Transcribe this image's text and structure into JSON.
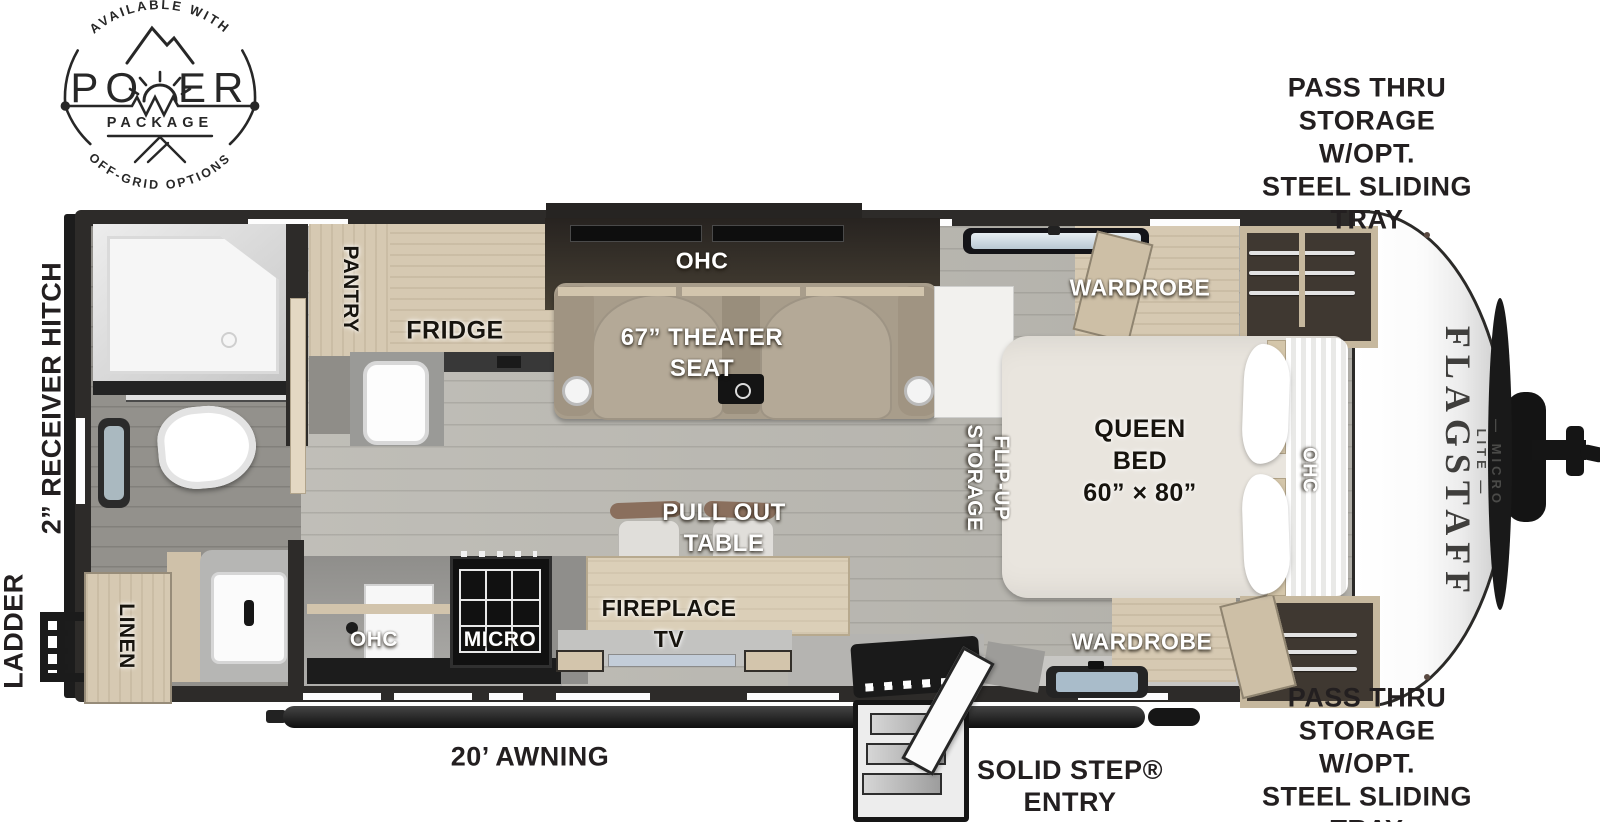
{
  "logo": {
    "arc_top": "AVAILABLE WITH",
    "word_left": "PO",
    "word_right": "ER",
    "subtitle": "PACKAGE",
    "arc_bottom": "OFF-GRID OPTIONS"
  },
  "brand": {
    "name": "FLAGSTAFF",
    "series": "— MICRO LITE —"
  },
  "callouts": {
    "pass_thru_top": "PASS THRU\nSTORAGE W/OPT.\nSTEEL SLIDING TRAY",
    "pass_thru_bottom": "PASS THRU\nSTORAGE W/OPT.\nSTEEL SLIDING TRAY",
    "receiver_hitch": "2” RECEIVER HITCH",
    "ladder": "LADDER",
    "awning": "20’ AWNING",
    "entry": "SOLID STEP®\nENTRY"
  },
  "rooms": {
    "pantry": "PANTRY",
    "fridge": "FRIDGE",
    "slide_ohc": "OHC",
    "theater_seat": "67” THEATER\nSEAT",
    "wardrobe_offdoor": "WARDROBE",
    "wardrobe_door": "WARDROBE",
    "flip_up_storage": "FLIP-UP\nSTORAGE",
    "queen_bed": "QUEEN\nBED\n60” × 80”",
    "bed_ohc": "OHC",
    "pull_out_table": "PULL OUT\nTABLE",
    "fireplace_tv": "FIREPLACE\nTV",
    "kitchen_ohc": "OHC",
    "micro": "MICRO",
    "linen": "LINEN"
  }
}
